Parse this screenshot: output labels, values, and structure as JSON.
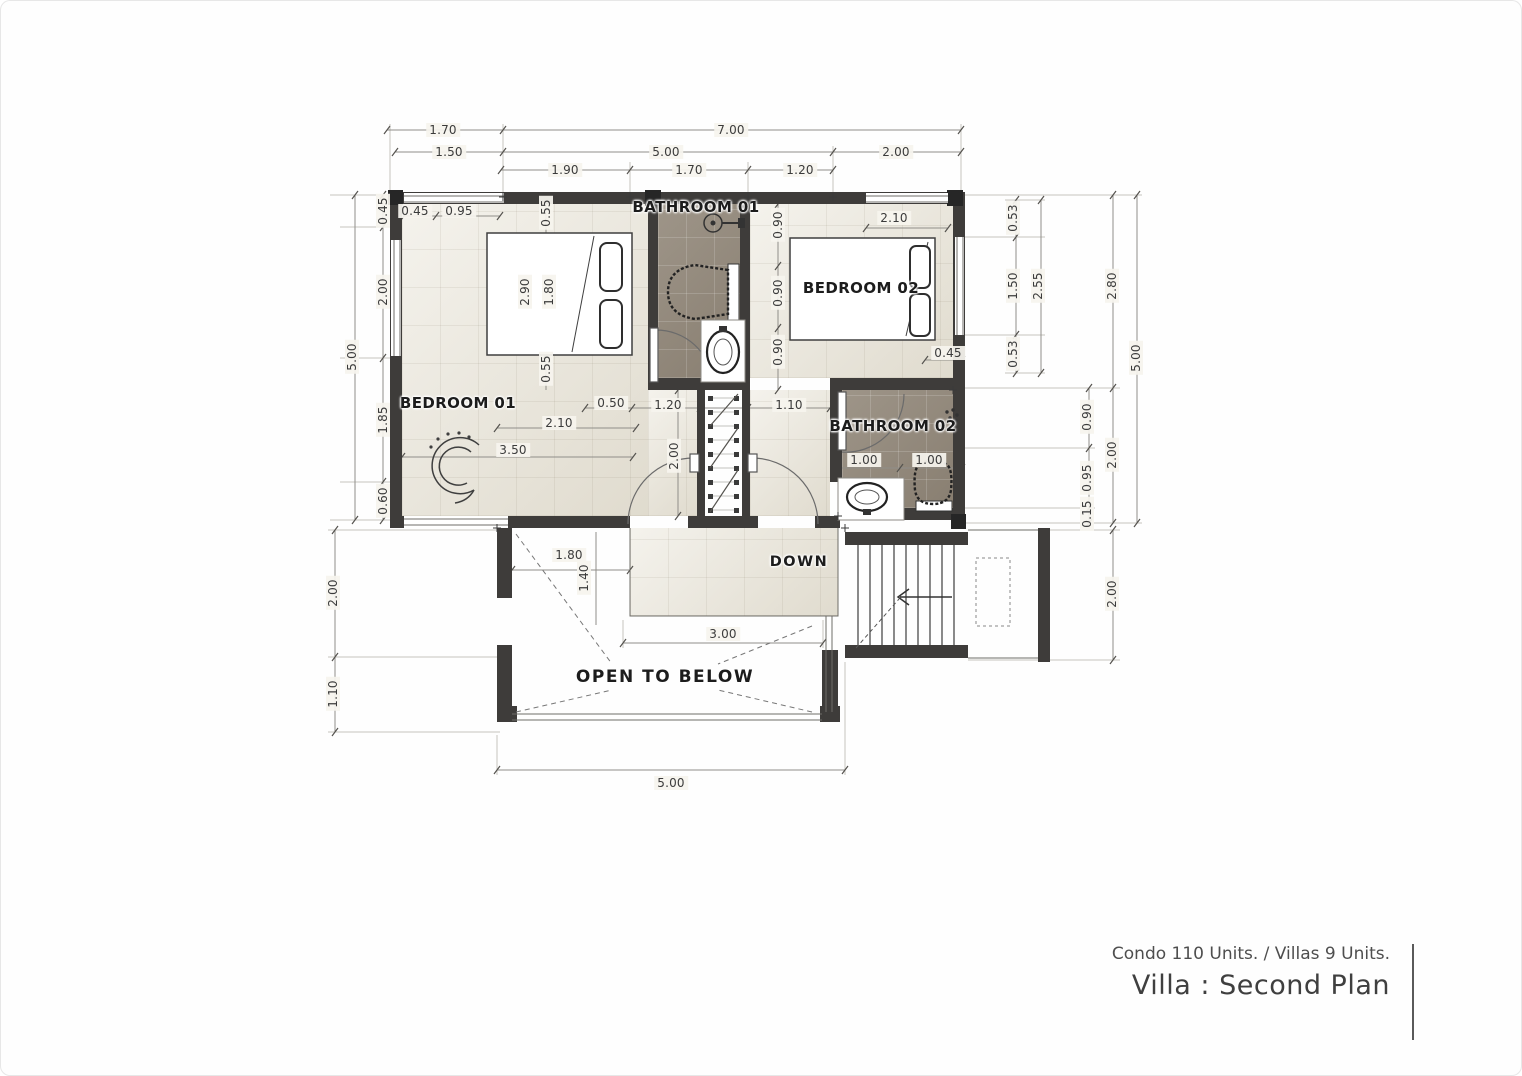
{
  "title_block": {
    "subtitle": "Condo 110 Units. / Villas 9 Units.",
    "title": "Villa : Second Plan"
  },
  "colors": {
    "wall": "#3e3c3a",
    "bathroom_floor": "#93897b",
    "bedroom_floor": "#eae6da",
    "dimension_text": "#3b3b3b",
    "title_text": "#3f3f3f"
  },
  "room_labels": [
    {
      "id": "bathroom-01",
      "text": "BATHROOM 01",
      "x": 696,
      "y": 207
    },
    {
      "id": "bedroom-02",
      "text": "BEDROOM 02",
      "x": 861,
      "y": 288
    },
    {
      "id": "bedroom-01",
      "text": "BEDROOM 01",
      "x": 458,
      "y": 403
    },
    {
      "id": "bathroom-02",
      "text": "BATHROOM 02",
      "x": 893,
      "y": 426
    },
    {
      "id": "down",
      "text": "DOWN",
      "x": 799,
      "y": 562
    },
    {
      "id": "open-to-below",
      "text": "OPEN TO BELOW",
      "x": 665,
      "y": 677
    }
  ],
  "dimensions": [
    {
      "t": "1.70",
      "x": 443,
      "y": 130
    },
    {
      "t": "7.00",
      "x": 731,
      "y": 130
    },
    {
      "t": "1.50",
      "x": 449,
      "y": 152
    },
    {
      "t": "5.00",
      "x": 666,
      "y": 152
    },
    {
      "t": "2.00",
      "x": 896,
      "y": 152
    },
    {
      "t": "1.90",
      "x": 565,
      "y": 170
    },
    {
      "t": "1.70",
      "x": 689,
      "y": 170
    },
    {
      "t": "1.20",
      "x": 800,
      "y": 170
    },
    {
      "t": "5.00",
      "x": 352,
      "y": 357,
      "r": 1
    },
    {
      "t": "0.45",
      "x": 383,
      "y": 211,
      "r": 1
    },
    {
      "t": "2.00",
      "x": 383,
      "y": 292,
      "r": 1
    },
    {
      "t": "1.85",
      "x": 383,
      "y": 420,
      "r": 1
    },
    {
      "t": "0.60",
      "x": 383,
      "y": 501,
      "r": 1
    },
    {
      "t": "2.00",
      "x": 333,
      "y": 593,
      "r": 1
    },
    {
      "t": "1.10",
      "x": 333,
      "y": 694,
      "r": 1
    },
    {
      "t": "0.53",
      "x": 1013,
      "y": 218,
      "r": 1
    },
    {
      "t": "1.50",
      "x": 1013,
      "y": 286,
      "r": 1
    },
    {
      "t": "0.53",
      "x": 1013,
      "y": 354,
      "r": 1
    },
    {
      "t": "2.55",
      "x": 1038,
      "y": 286,
      "r": 1
    },
    {
      "t": "2.80",
      "x": 1112,
      "y": 286,
      "r": 1
    },
    {
      "t": "5.00",
      "x": 1136,
      "y": 358,
      "r": 1
    },
    {
      "t": "0.90",
      "x": 1087,
      "y": 417,
      "r": 1
    },
    {
      "t": "0.95",
      "x": 1087,
      "y": 478,
      "r": 1
    },
    {
      "t": "0.15",
      "x": 1087,
      "y": 514,
      "r": 1
    },
    {
      "t": "2.00",
      "x": 1112,
      "y": 455,
      "r": 1
    },
    {
      "t": "2.00",
      "x": 1112,
      "y": 594,
      "r": 1
    },
    {
      "t": "0.45",
      "x": 415,
      "y": 211
    },
    {
      "t": "0.95",
      "x": 459,
      "y": 211
    },
    {
      "t": "0.55",
      "x": 546,
      "y": 213,
      "r": 1
    },
    {
      "t": "2.90",
      "x": 525,
      "y": 292,
      "r": 1
    },
    {
      "t": "1.80",
      "x": 549,
      "y": 292,
      "r": 1
    },
    {
      "t": "0.55",
      "x": 546,
      "y": 369,
      "r": 1
    },
    {
      "t": "0.90",
      "x": 778,
      "y": 225,
      "r": 1
    },
    {
      "t": "0.90",
      "x": 778,
      "y": 293,
      "r": 1
    },
    {
      "t": "0.90",
      "x": 778,
      "y": 352,
      "r": 1
    },
    {
      "t": "2.10",
      "x": 894,
      "y": 218
    },
    {
      "t": "0.45",
      "x": 948,
      "y": 353
    },
    {
      "t": "0.50",
      "x": 611,
      "y": 403
    },
    {
      "t": "1.20",
      "x": 668,
      "y": 405
    },
    {
      "t": "1.10",
      "x": 789,
      "y": 405
    },
    {
      "t": "2.10",
      "x": 559,
      "y": 423
    },
    {
      "t": "3.50",
      "x": 513,
      "y": 450
    },
    {
      "t": "2.00",
      "x": 674,
      "y": 456,
      "r": 1
    },
    {
      "t": "1.00",
      "x": 864,
      "y": 460
    },
    {
      "t": "1.00",
      "x": 929,
      "y": 460
    },
    {
      "t": "1.80",
      "x": 569,
      "y": 555
    },
    {
      "t": "1.40",
      "x": 584,
      "y": 578,
      "r": 1
    },
    {
      "t": "3.00",
      "x": 723,
      "y": 634
    },
    {
      "t": "5.00",
      "x": 671,
      "y": 783
    }
  ]
}
